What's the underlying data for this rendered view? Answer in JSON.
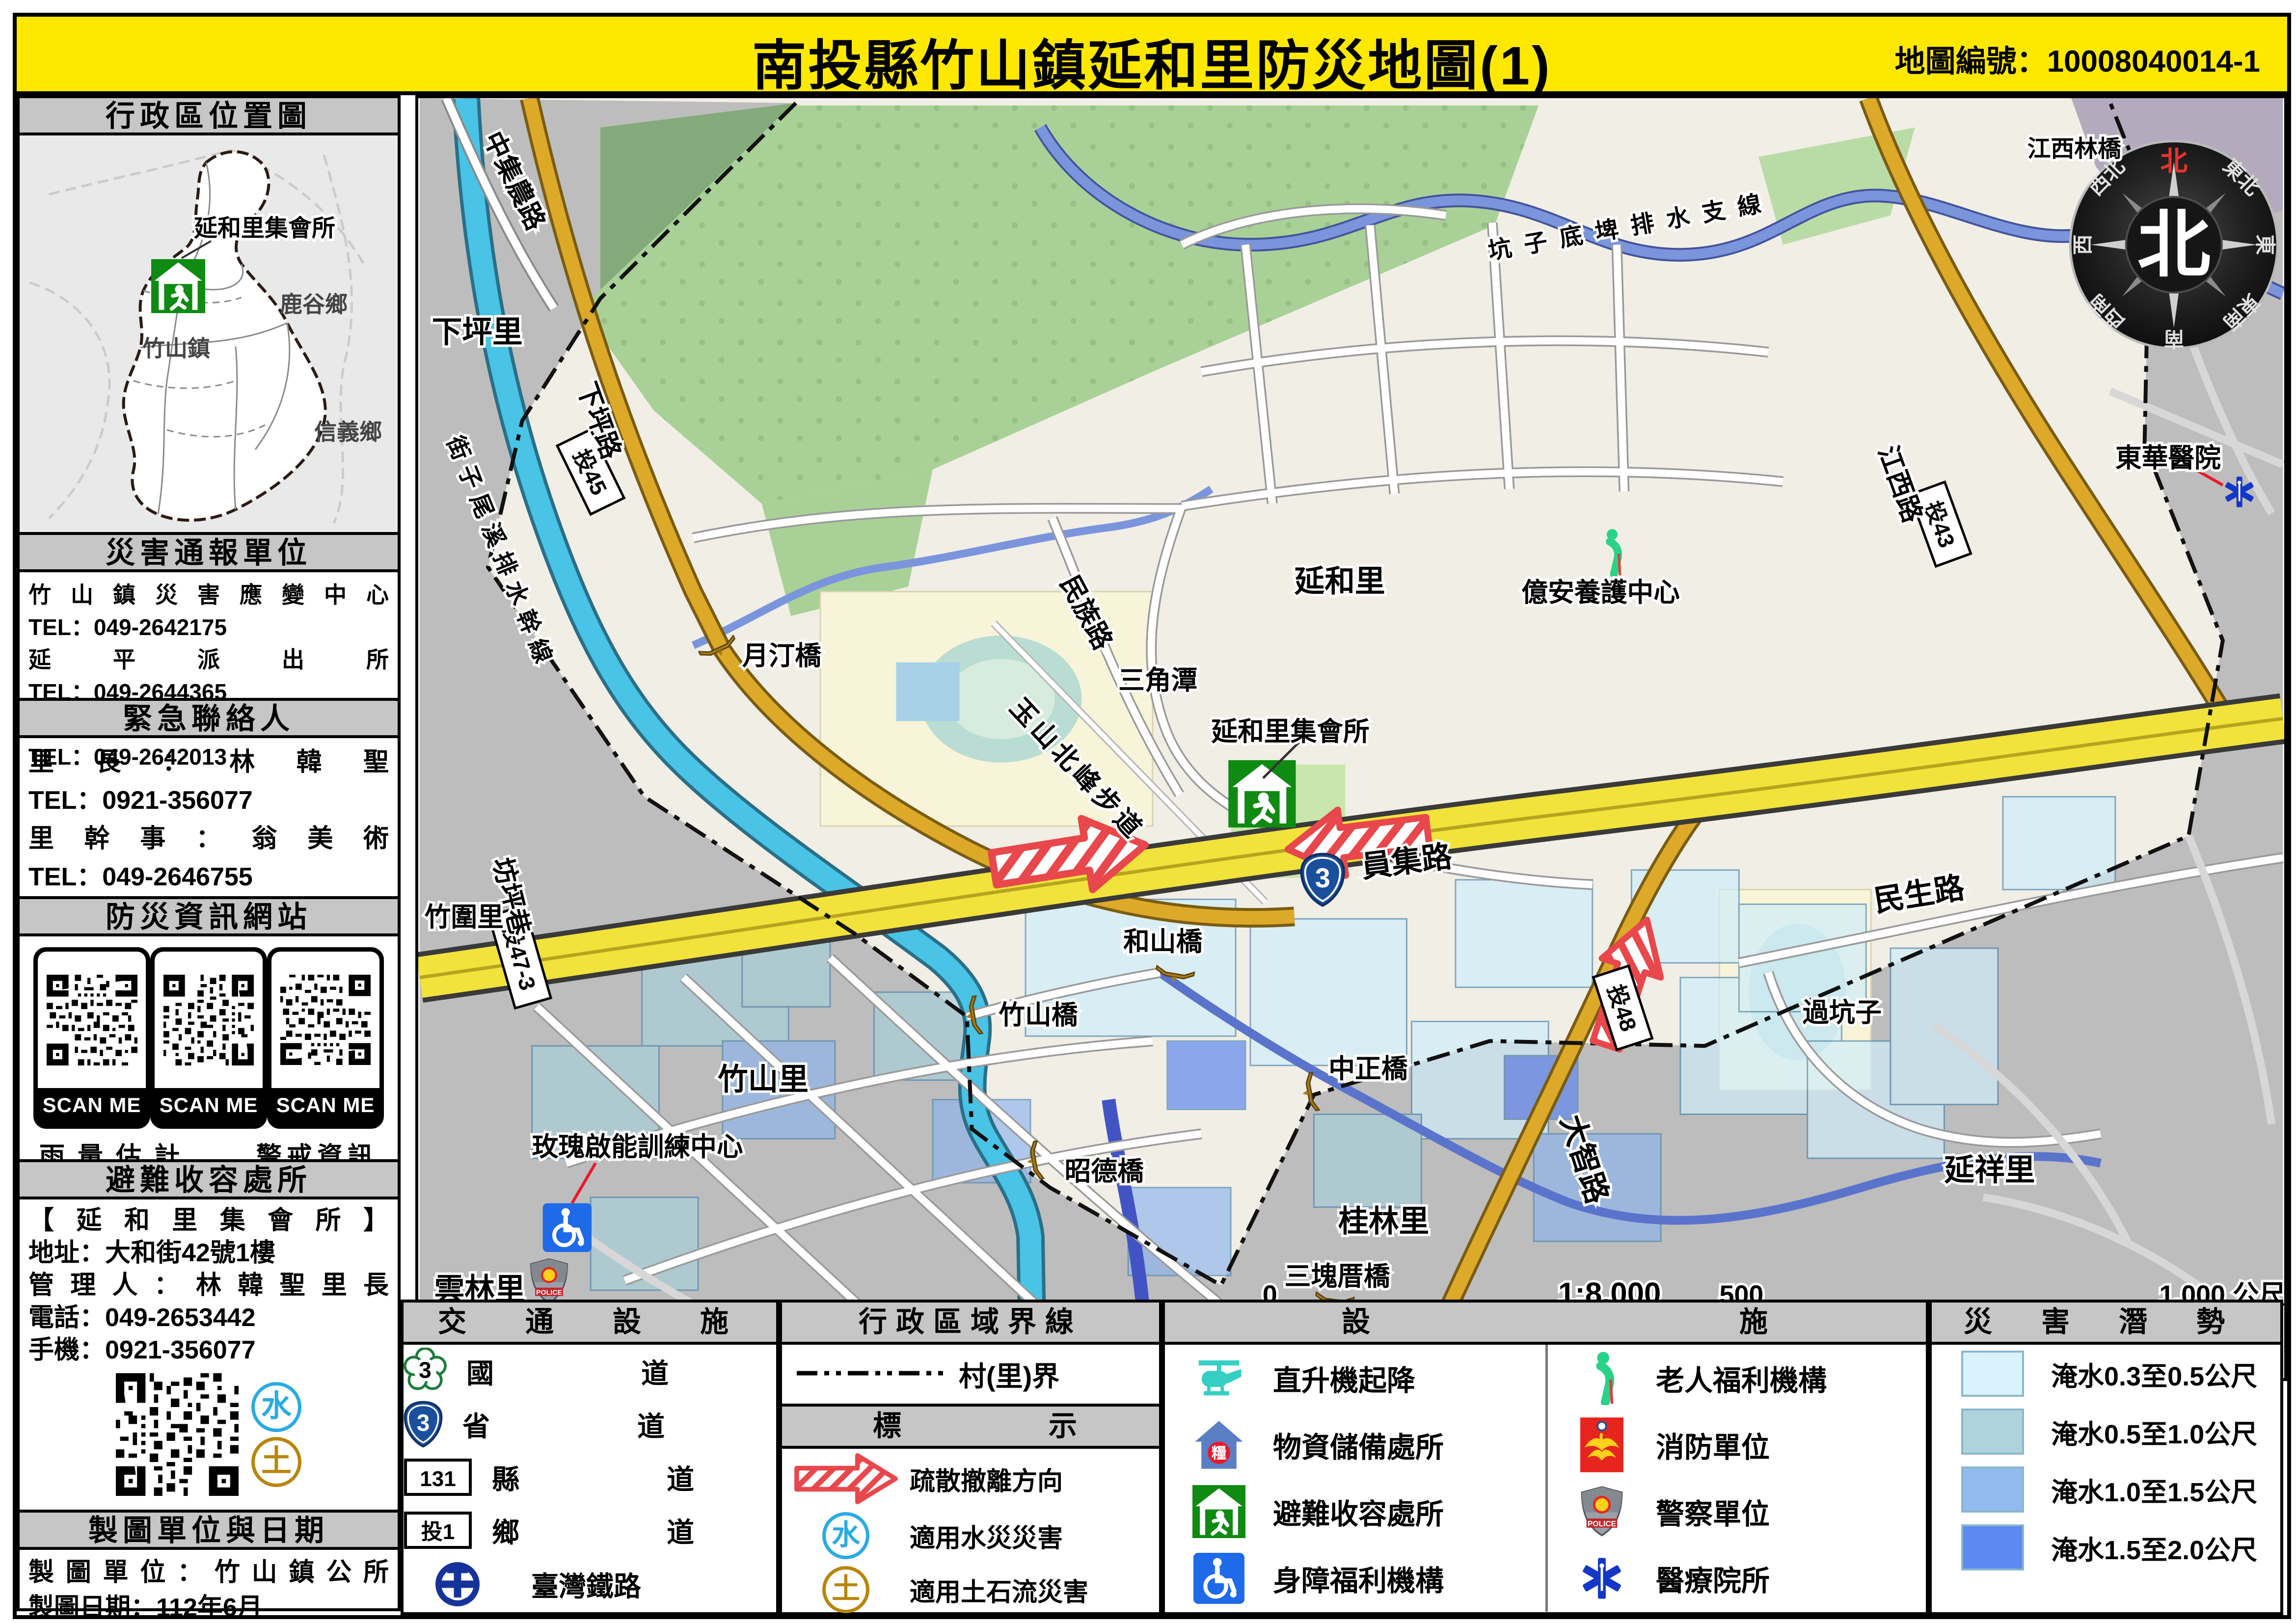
{
  "page": {
    "title": "南投縣竹山鎮延和里防災地圖(1)",
    "map_no": "地圖編號：10008040014-1"
  },
  "sidebar": {
    "loc": {
      "header": "行政區位置圖",
      "shelter_label": "延和里集會所",
      "town_lugu": "鹿谷鄉",
      "town_zhushan": "竹山鎮",
      "town_xinyi": "信義鄉"
    },
    "report": {
      "header": "災害通報單位",
      "l1": "竹山鎮災害應變中心",
      "l2": "TEL：049-2642175",
      "l3": "延平派出所",
      "l4": "TEL：049-2644365",
      "l5": "竹山消防分隊",
      "l6": "TEL：049-2642013"
    },
    "contacts": {
      "header": "緊急聯絡人",
      "l1": "里長：林韓聖",
      "l2": "TEL：0921-356077",
      "l3": "里幹事：翁美術",
      "l4": "TEL：049-2646755"
    },
    "web": {
      "header": "防災資訊網站",
      "scan": "SCAN ME",
      "cap1": "雨量估計",
      "cap2": "警戒資訊"
    },
    "shelter": {
      "header": "避難收容處所",
      "name": "【延和里集會所】",
      "addr": "地址：大和街42號1樓",
      "mgr": "管理人：林韓聖里長",
      "tel": "電話：049-2653442",
      "mobile": "手機：0921-356077",
      "water": "水",
      "soil": "土"
    },
    "credits": {
      "header": "製圖單位與日期",
      "unit": "製圖單位：竹山鎮公所",
      "date": "製圖日期：112年6月"
    }
  },
  "map": {
    "labels": {
      "zhongji_rd": "中集農路",
      "xiaping_li": "下坪里",
      "drain_branch": "坑子底埤排水支線",
      "jiangxilin_bridge": "江西林橋",
      "donghua_hospital": "東華醫院",
      "jiangxi_rd": "江西路",
      "yanhe_li": "延和里",
      "yian_center": "億安養護中心",
      "minzu_rd": "民族路",
      "sanjiaotan": "三角潭",
      "yueting_bridge": "月汀橋",
      "xiaping_rd": "下坪路",
      "drain_main": "街子尾溪排水幹線",
      "yushan_trail": "玉山北峰步道",
      "shelter": "延和里集會所",
      "yuanji_rd": "員集路",
      "minsheng_rd": "民生路",
      "guokengzi": "過坑子",
      "fangping_lane": "坊坪巷",
      "zhuwei_li": "竹圍里",
      "zhushan_bridge": "竹山橋",
      "heshan_bridge": "和山橋",
      "zhushan_li": "竹山里",
      "zhongzheng_bridge": "中正橋",
      "dazhi_rd": "大智路",
      "zhaode_bridge": "昭德橋",
      "guilin_li": "桂林里",
      "rose_center": "玫瑰啟能訓練中心",
      "police_branch": "竹山分局",
      "yunlin_li": "雲林里",
      "sankuaicuo_bridge": "三塊厝橋",
      "yanxiang_li": "延祥里"
    },
    "compass": {
      "center": "北",
      "n": "北",
      "nw": "西北",
      "ne": "東北",
      "w": "西",
      "e": "東",
      "sw": "西南",
      "s": "南",
      "se": "東南"
    },
    "scale": {
      "zero": "0",
      "ratio": "1:8,000",
      "mid": "500",
      "end": "1,000 公尺"
    },
    "shields": {
      "national": "3",
      "provincial": "3",
      "county": "131",
      "t1": "投1",
      "t43": "投43",
      "t45": "投45",
      "t47": "投47-3",
      "t48": "投48"
    }
  },
  "legend": {
    "transport": {
      "header": "交通設施",
      "r1": "國道",
      "r2": "省道",
      "r3": "縣道",
      "r4": "鄉道",
      "r5": "臺灣鐵路"
    },
    "admin": {
      "header": "行政區域界線",
      "village": "村(里)界",
      "marks_header": "標示",
      "m1": "疏散撤離方向",
      "m2": "適用水災災害",
      "m3": "適用土石流災害"
    },
    "facilities": {
      "header": "設施",
      "c1r1": "直升機起降",
      "c1r2": "物資儲備處所",
      "c1r3": "避難收容處所",
      "c1r4": "身障福利機構",
      "c2r1": "老人福利機構",
      "c2r2": "消防單位",
      "c2r3": "警察單位",
      "c2r4": "醫療院所"
    },
    "hazard": {
      "header": "災害潛勢",
      "r1": {
        "color": "#d9f2fb",
        "label": "淹水0.3至0.5公尺"
      },
      "r2": {
        "color": "#aed3dc",
        "label": "淹水0.5至1.0公尺"
      },
      "r3": {
        "color": "#91baee",
        "label": "淹水1.0至1.5公尺"
      },
      "r4": {
        "color": "#5c8af2",
        "label": "淹水1.5至2.0公尺"
      }
    },
    "icons": {
      "grain": "糧",
      "police_text": "POLICE"
    }
  },
  "colors": {
    "title_bg": "#ffe800",
    "header_bg": "#c6c6c6",
    "map_base": "#f1eee6",
    "outside": "#bdbdbd",
    "forest": "#a9d197",
    "river": "#49c3e6",
    "stream": "#6d88d8",
    "highway": "#f2e23c",
    "gold_road": "#dda929",
    "evac_red": "#e8474b",
    "shelter_green": "#0f8a12"
  }
}
